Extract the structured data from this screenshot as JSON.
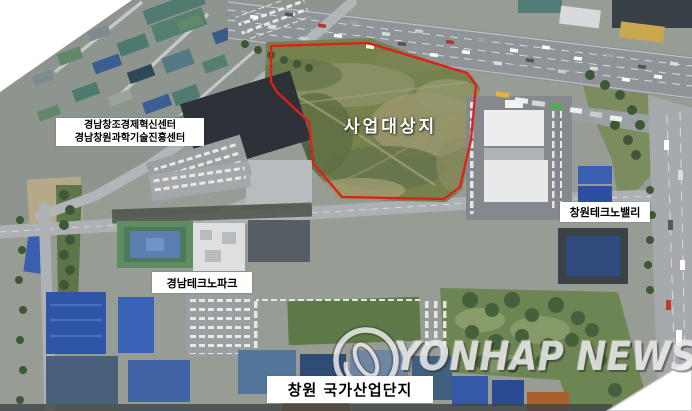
{
  "annotations": {
    "center_site": {
      "text": "사업대상지"
    },
    "innovation_center": {
      "line1": "경남창조경제혁신센터",
      "line2": "경남창원과학기술진흥센터"
    },
    "techno_valley": {
      "text": "창원테크노밸리"
    },
    "techno_park": {
      "text": "경남테크노파크"
    },
    "industrial_complex": {
      "text": "창원 국가산업단지"
    }
  },
  "watermark": {
    "text": "YONHAP NEWS",
    "logo": "yonhap-circle-logo"
  },
  "colors": {
    "site_outline": "#e11d1d",
    "label_bg": "#ffffff",
    "label_text": "#000000",
    "watermark_text": "#ebebeb",
    "field_green": "#76824e",
    "road_gray": "#aeb2b4",
    "factory_blue": "#2f55a8"
  }
}
